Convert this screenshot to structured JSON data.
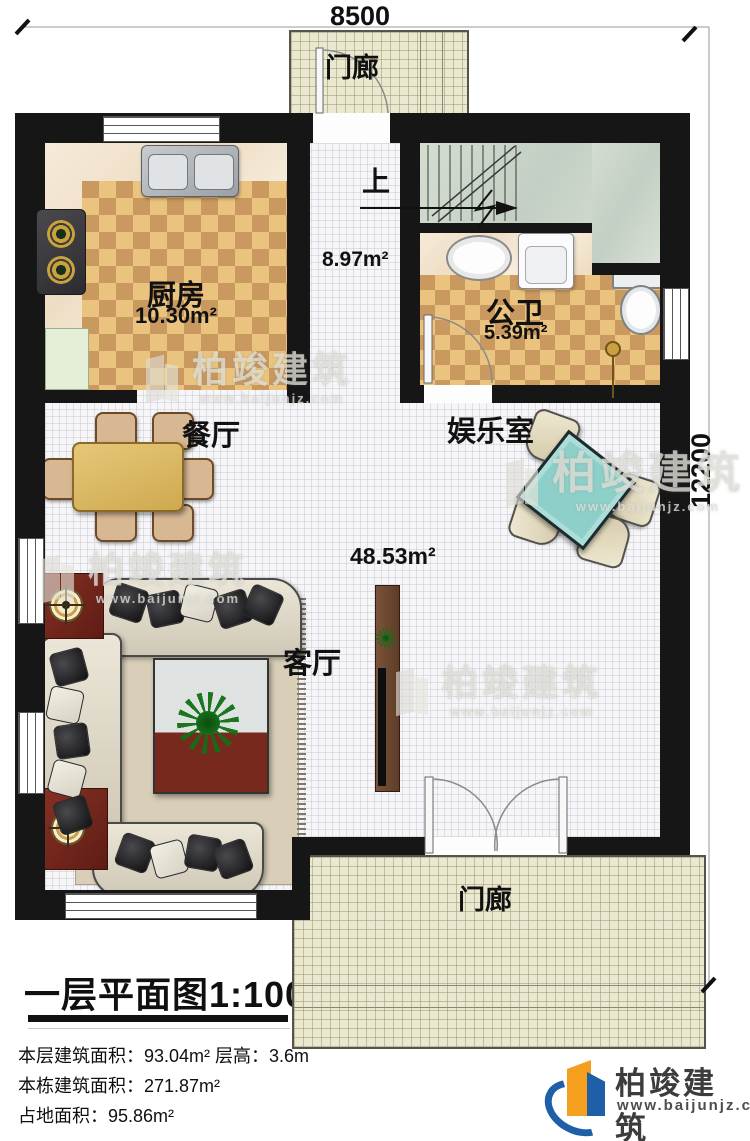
{
  "dimensions": {
    "top": "8500",
    "right": "12200"
  },
  "stairs": {
    "up": "上"
  },
  "rooms": {
    "porch_top": "门廊",
    "kitchen": {
      "name": "厨房",
      "area": "10.30m²"
    },
    "hallway": {
      "area": "8.97m²"
    },
    "bathroom": {
      "name": "公卫",
      "area": "5.39m²"
    },
    "dining": {
      "name": "餐厅"
    },
    "entertainment": {
      "name": "娱乐室"
    },
    "living": {
      "name": "客厅",
      "area": "48.53m²"
    },
    "porch_bottom": "门廊"
  },
  "title_block": {
    "title": "一层平面图1:100",
    "line1": "本层建筑面积：93.04m² 层高：3.6m",
    "line2": "本栋建筑面积：271.87m²",
    "line3": "占地面积：95.86m²"
  },
  "branding": {
    "name": "柏竣建筑",
    "url": "www.baijunjz.com"
  },
  "watermark": {
    "name": "柏竣建筑",
    "url": "www.baijunjz.com"
  },
  "colors": {
    "wall": "#161616",
    "checker_light": "#eac47f",
    "checker_dark": "#c9995f",
    "stairs_floor": "#ccd6cb",
    "porch_tile": "#eae8d1",
    "table_wood": "#dcba6a",
    "mahjong_table": "#8ed0c9",
    "accent_red": "#7b2b20",
    "logo_orange": "#f59f1e",
    "logo_blue": "#1f5fa8"
  }
}
